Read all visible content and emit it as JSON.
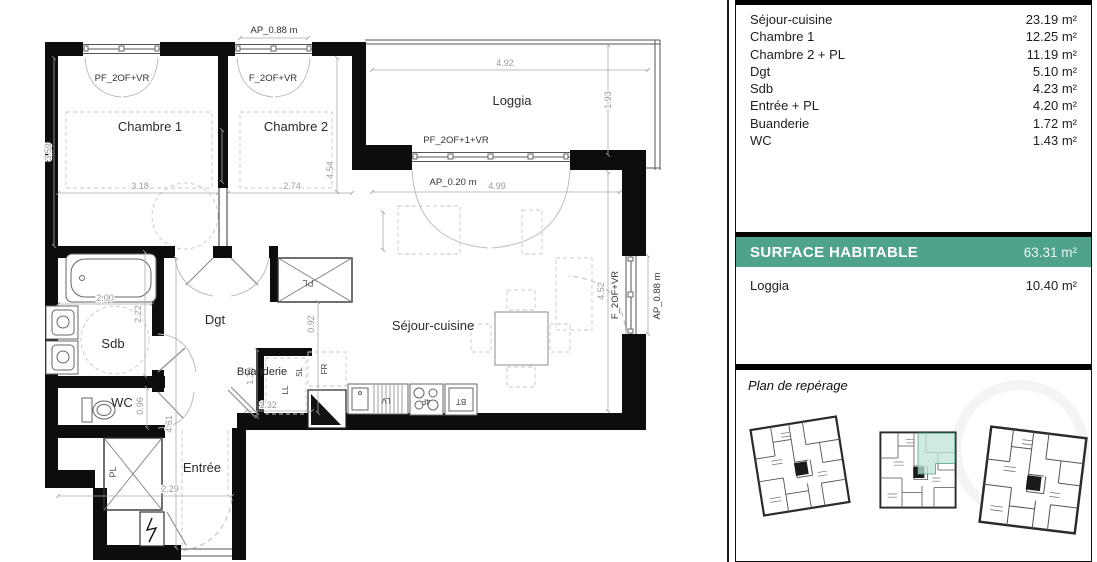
{
  "sidebar": {
    "rooms": [
      {
        "label": "Séjour-cuisine",
        "area": "23.19 m²"
      },
      {
        "label": "Chambre 1",
        "area": "12.25 m²"
      },
      {
        "label": "Chambre 2 + PL",
        "area": "11.19 m²"
      },
      {
        "label": "Dgt",
        "area": "5.10 m²"
      },
      {
        "label": "Sdb",
        "area": "4.23 m²"
      },
      {
        "label": "Entrée + PL",
        "area": "4.20 m²"
      },
      {
        "label": "Buanderie",
        "area": "1.72 m²"
      },
      {
        "label": "WC",
        "area": "1.43 m²"
      }
    ],
    "surface_title": "SURFACE HABITABLE",
    "surface_value": "63.31 m²",
    "annex_label": "Loggia",
    "annex_value": "10.40 m²",
    "reperage_title": "Plan de repérage"
  },
  "plan": {
    "rooms": {
      "chambre1": "Chambre 1",
      "chambre2": "Chambre 2",
      "loggia": "Loggia",
      "sejour": "Séjour-cuisine",
      "dgt": "Dgt",
      "sdb": "Sdb",
      "wc": "WC",
      "buanderie": "Buanderie",
      "entree": "Entrée",
      "pl": "PL"
    },
    "windows": {
      "pf2": "PF_2OF+VR",
      "f2": "F_2OF+VR",
      "pf21": "PF_2OF+1+VR",
      "ap088": "AP_0.88 m",
      "ap020": "AP_0.20 m"
    },
    "appliances": {
      "fr": "FR",
      "lv": "LV",
      "bt": "BT",
      "ll": "LL",
      "sl": "SL",
      "hob": "4F"
    },
    "dims": {
      "d492": "4.92",
      "d193": "1.93",
      "d499": "4.99",
      "d452": "4.52",
      "d359": "3.59",
      "d318": "3.18",
      "d274": "2.74",
      "d454": "4.54",
      "d200": "2.00",
      "d222": "2.22",
      "d092": "0.92",
      "d096": "0.96",
      "d130": "1.30",
      "d132": "1.32",
      "d461": "4.61",
      "d229": "2.29"
    }
  },
  "colors": {
    "accent": "#4FA28B",
    "highlight": "#BFE3DA",
    "wall": "#0d0d0d"
  }
}
